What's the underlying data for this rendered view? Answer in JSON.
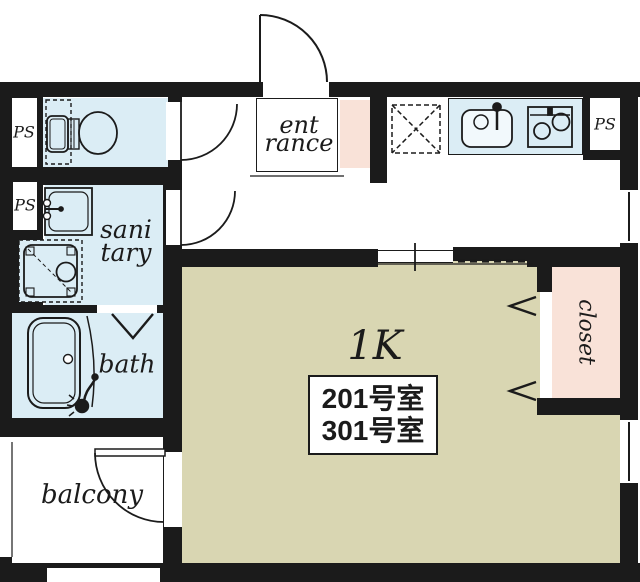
{
  "floor_plan": {
    "unit_type": "1K",
    "room_numbers": {
      "line1": "201号室",
      "line2": "301号室"
    },
    "rooms": {
      "entrance": {
        "line1": "ent",
        "line2": "rance"
      },
      "sanitary": {
        "line1": "sani",
        "line2": "tary"
      },
      "bath": {
        "label": "bath"
      },
      "balcony": {
        "label": "balcony"
      },
      "closet": {
        "label": "closet"
      },
      "pipe_space": {
        "label": "PS"
      },
      "main_room": {
        "label": "1K"
      }
    },
    "fixtures": {
      "toilet": "toilet-icon",
      "washbasin": "washbasin-icon",
      "washing_machine": "washing-machine-icon",
      "bathtub": "bathtub-icon",
      "shower": "shower-icon",
      "kitchen_sink": "kitchen-sink-icon",
      "stove": "stove-icon",
      "refrigerator_space": "refrigerator-space-icon"
    },
    "colors": {
      "wall": "#1b1b1b",
      "wet_rooms": "#dbedf5",
      "main_room": "#d9d6b2",
      "storage": "#f9e2d8",
      "floor": "#ffffff"
    }
  }
}
